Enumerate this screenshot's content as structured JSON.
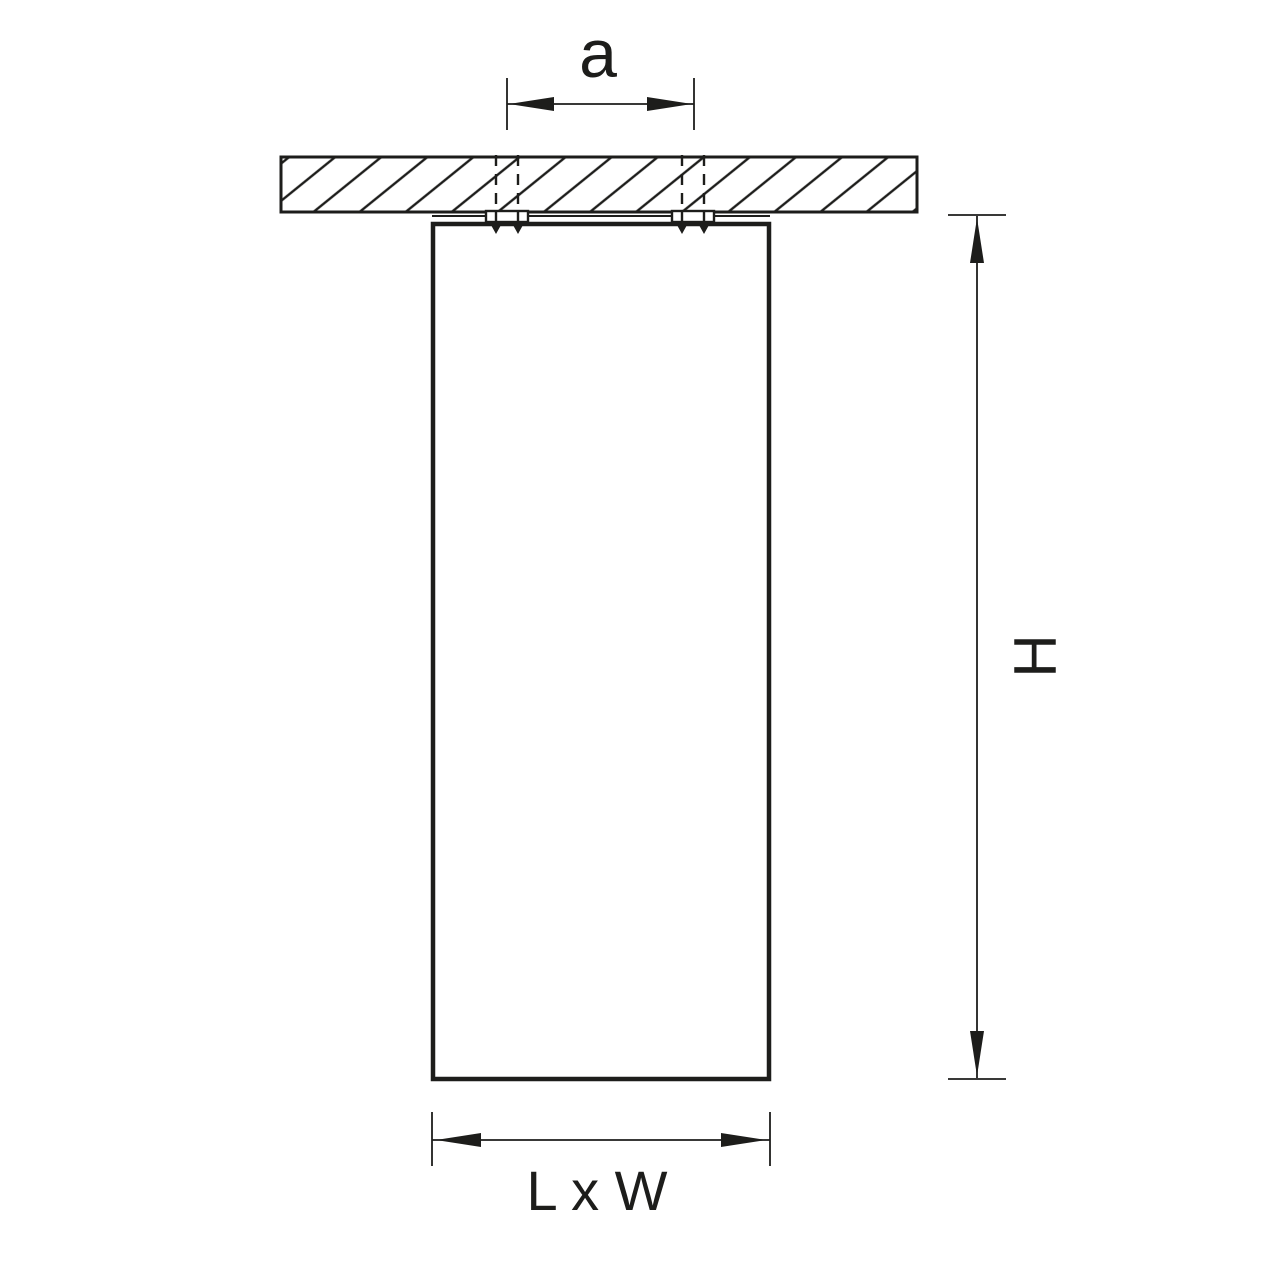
{
  "diagram": {
    "type": "technical-dimension-drawing",
    "background": "#ffffff",
    "line_color": "#1d1d1b",
    "labels": {
      "top_dimension": "a",
      "height_dimension": "H",
      "base_dimension": "L x W"
    }
  }
}
